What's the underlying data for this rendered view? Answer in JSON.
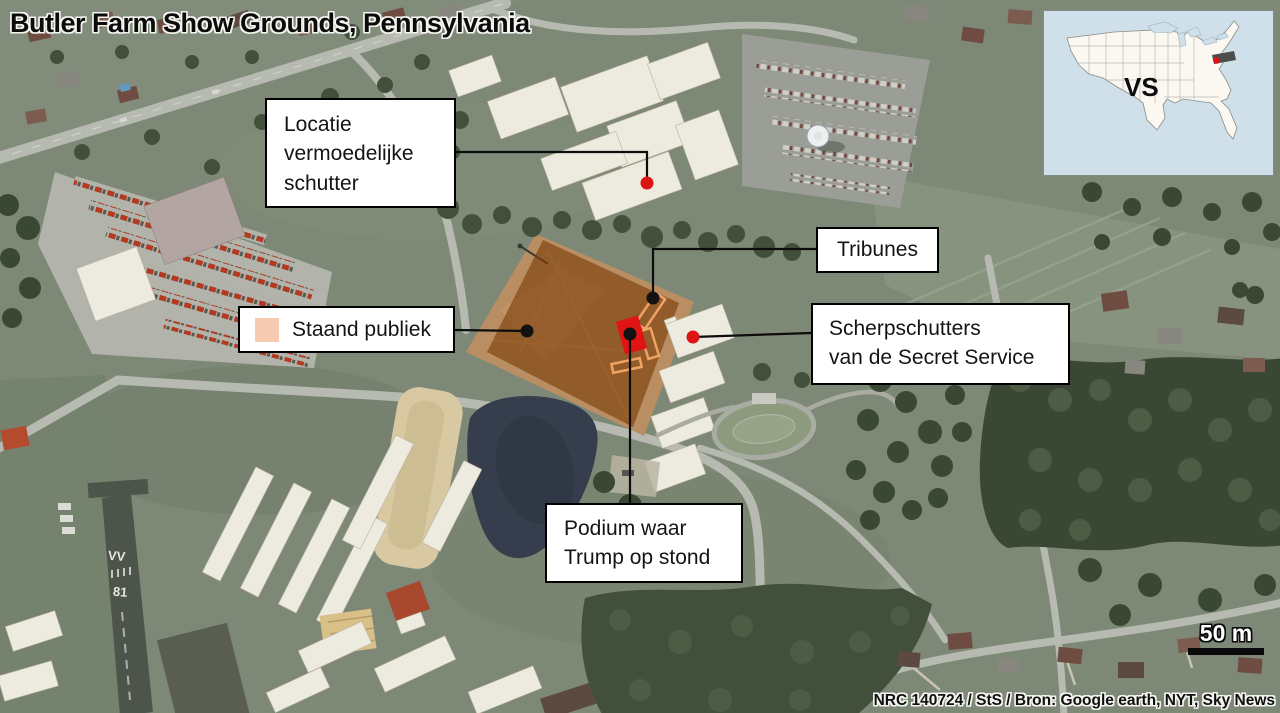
{
  "title": "Butler Farm Show Grounds, Pennsylvania",
  "inset_map": {
    "country_label": "VS",
    "highlighted_state": "Pennsylvania",
    "water_color": "#cfe0ea",
    "land_color": "#faf8f1",
    "state_highlight_color": "#4d4d4d",
    "marker_color": "#dd1414"
  },
  "annotations": {
    "shooter": {
      "lines": [
        "Locatie",
        "vermoedelijke",
        "schutter"
      ],
      "marker_color": "#dd1414"
    },
    "tribunes": {
      "label": "Tribunes",
      "marker_color": "#121212"
    },
    "staand_publiek": {
      "label": "Staand publiek",
      "swatch_color": "#f7cbb1",
      "marker_color": "#121212"
    },
    "scherpschutters": {
      "lines": [
        "Scherpschutters",
        "van de Secret Service"
      ],
      "marker_color": "#dd1414"
    },
    "podium": {
      "lines": [
        "Podium waar",
        "Trump op stond"
      ],
      "marker_color": "#121212",
      "podium_color": "#e01414"
    }
  },
  "map_features": {
    "overlay_color": "#7a3c08",
    "tribune_outline_color": "#f0a264",
    "runway_marks": [
      "VV",
      "81"
    ]
  },
  "scale_bar": {
    "label": "50 m"
  },
  "credit": "NRC 140724 / StS / Bron: Google earth, NYT, Sky News"
}
